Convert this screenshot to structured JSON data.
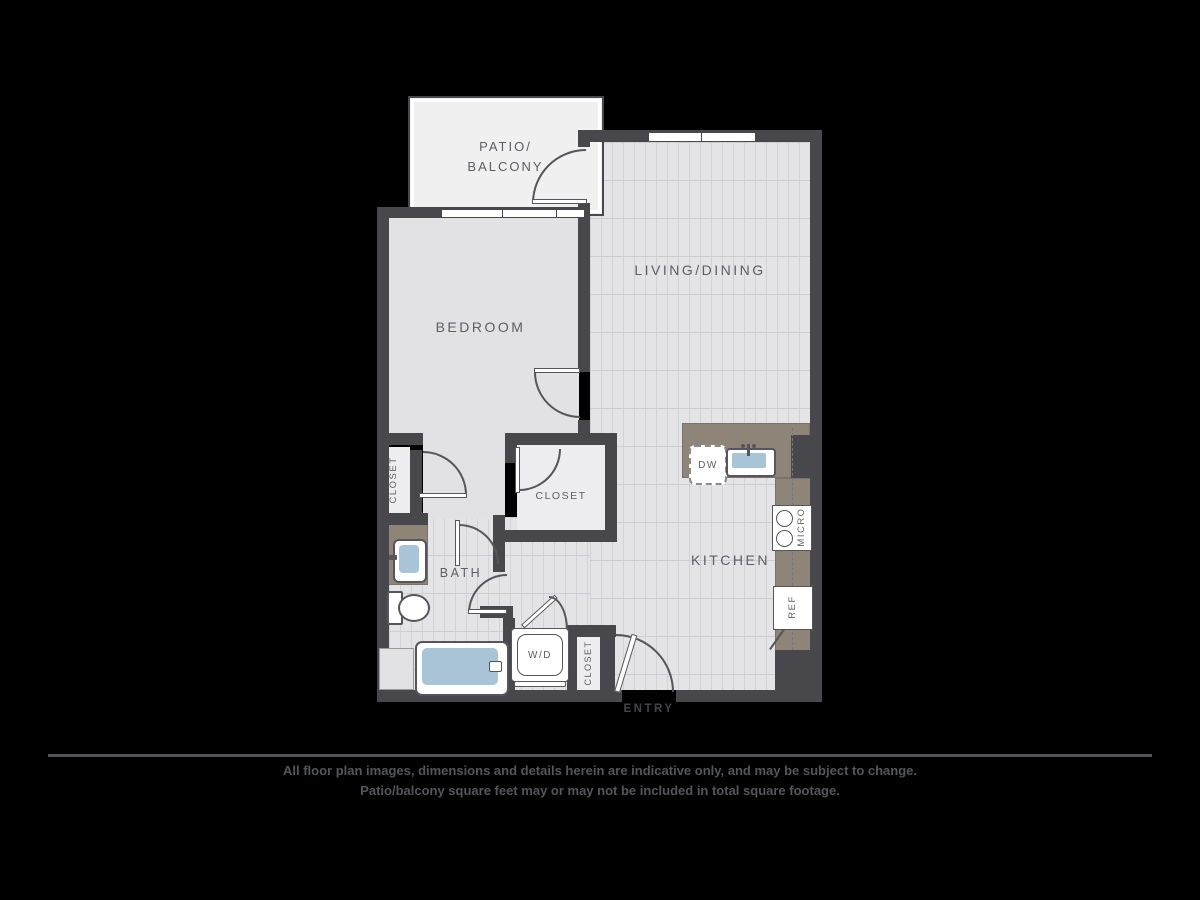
{
  "floor_plan": {
    "rooms": {
      "patio": {
        "label_line1": "PATIO/",
        "label_line2": "BALCONY"
      },
      "living_dining": {
        "label": "LIVING/DINING"
      },
      "bedroom": {
        "label": "BEDROOM"
      },
      "bath": {
        "label": "BATH"
      },
      "kitchen": {
        "label": "KITCHEN"
      },
      "closet_bedroom": {
        "label": "CLOSET"
      },
      "closet_hall": {
        "label": "CLOSET"
      },
      "closet_entry": {
        "label": "CLOSET"
      },
      "entry": {
        "label": "ENTRY"
      }
    },
    "appliances": {
      "dishwasher": {
        "label": "DW"
      },
      "microwave": {
        "label": "MICRO"
      },
      "refrigerator": {
        "label": "REF"
      },
      "washer_dryer": {
        "label": "W/D"
      }
    },
    "colors": {
      "background": "#000000",
      "wall": "#48484c",
      "plank_floor": "#e4e4e6",
      "plain_floor": "#e2e2e4",
      "patio_floor": "#f0f0f1",
      "closet_floor": "#ededef",
      "counter": "#8e8478",
      "fixture_blue": "#a9c4d7",
      "label_text": "#5e5e63",
      "disclaimer_text": "#55565b"
    }
  },
  "disclaimer": {
    "line1": "All floor plan images, dimensions and details herein are indicative only, and may be subject to change.",
    "line2": "Patio/balcony square feet may or may not be included in total square footage."
  }
}
